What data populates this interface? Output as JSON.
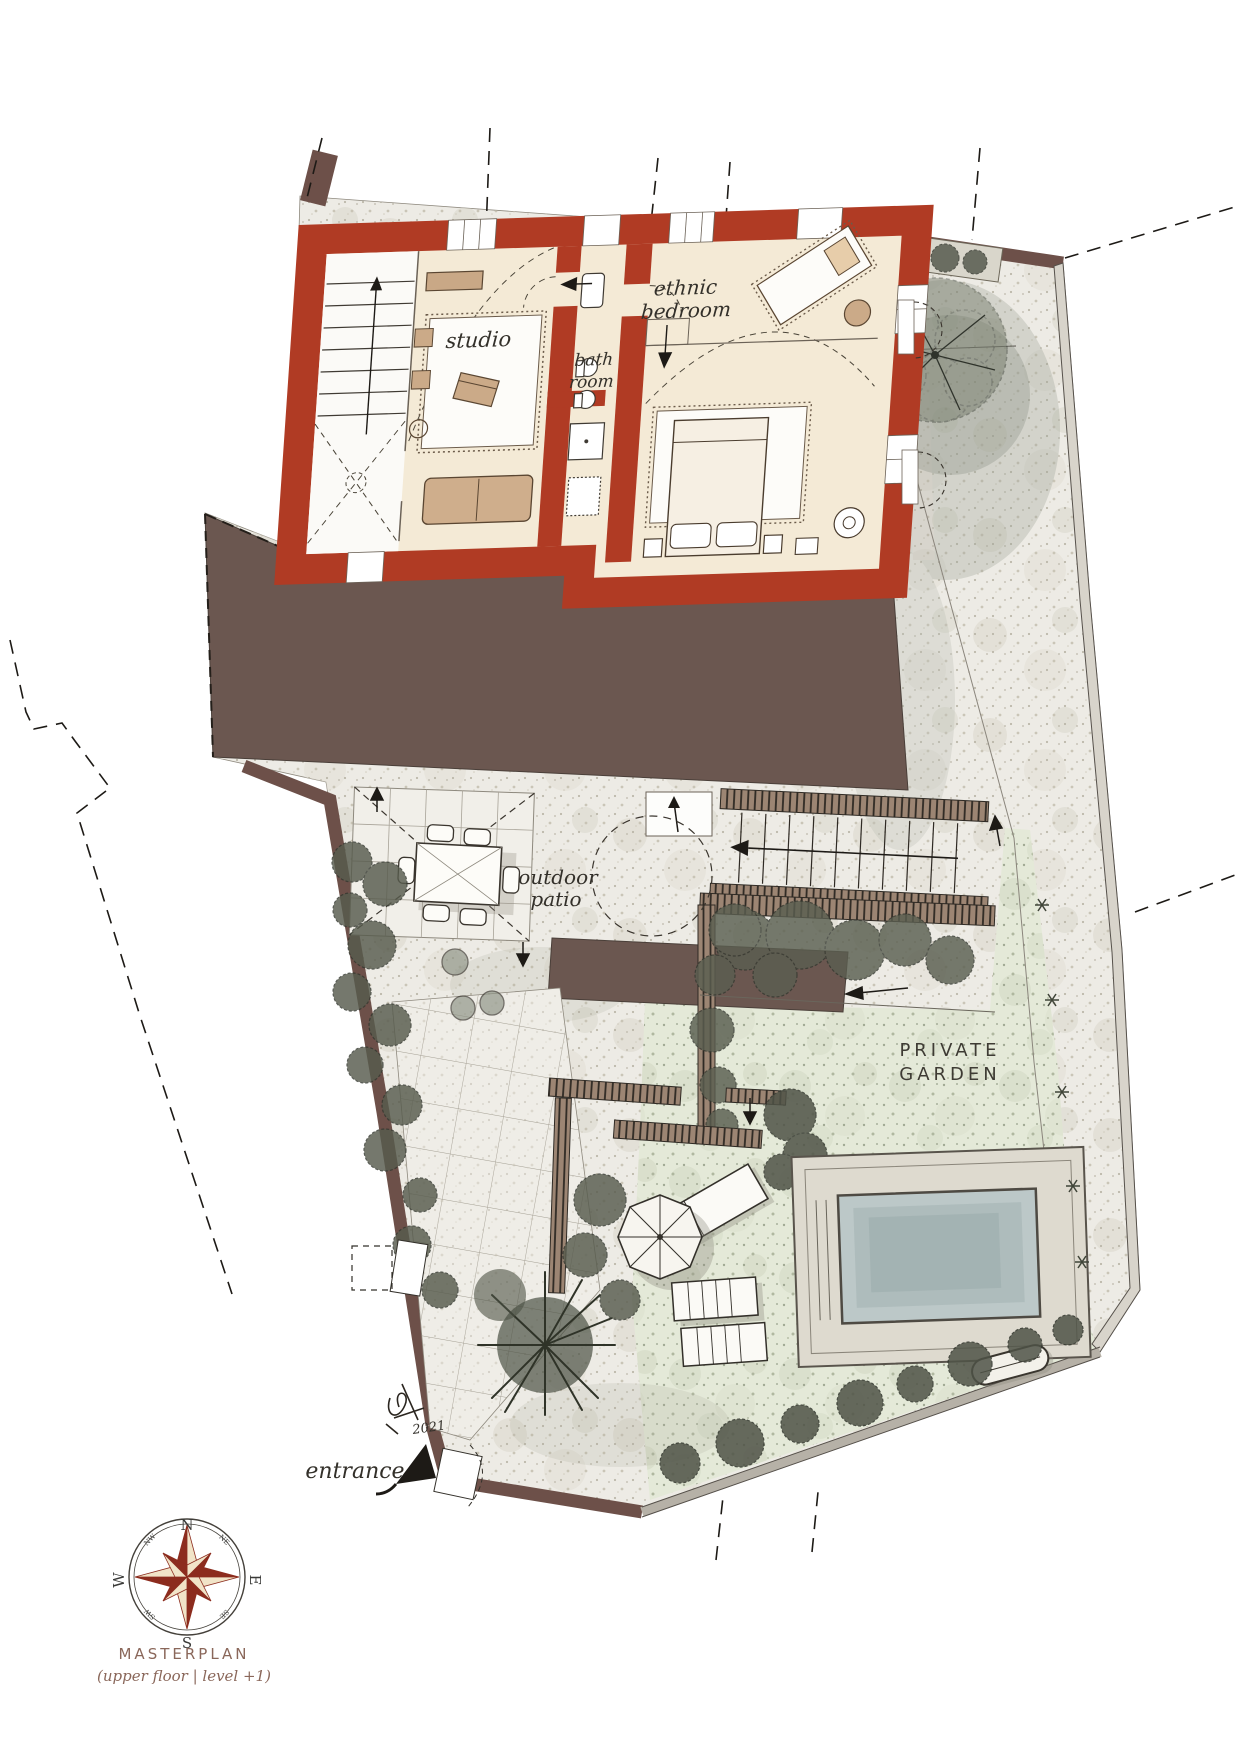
{
  "drawing": {
    "title": "MASTERPLAN",
    "subtitle": "(upper floor | level +1)",
    "signature_year": "2021",
    "labels": {
      "studio": "studio",
      "bath_line1": "bath",
      "bath_line2": "room",
      "bedroom_line1": "ethnic",
      "bedroom_line2": "bedroom",
      "patio_line1": "outdoor",
      "patio_line2": "patio",
      "garden_line1": "PRIVATE",
      "garden_line2": "GARDEN",
      "entrance": "entrance"
    },
    "compass": {
      "north": "N",
      "south": "S",
      "east": "E",
      "west": "W",
      "northeast": "NE",
      "northwest": "NW",
      "southeast": "SE",
      "southwest": "SW"
    },
    "colors": {
      "wall_red": "#b03b24",
      "roof_brown": "#6b5750",
      "floor_cream": "#f4ead6",
      "stone_path": "#edebe5",
      "garden_green": "#e4e9d8",
      "pool_water": "#bcc8c8",
      "foliage_dark": "#575b4d",
      "boundary_wall": "#6d5049",
      "compass_red": "#8c2c1e",
      "ink": "#33302a",
      "caption_brown": "#8a675a"
    }
  }
}
